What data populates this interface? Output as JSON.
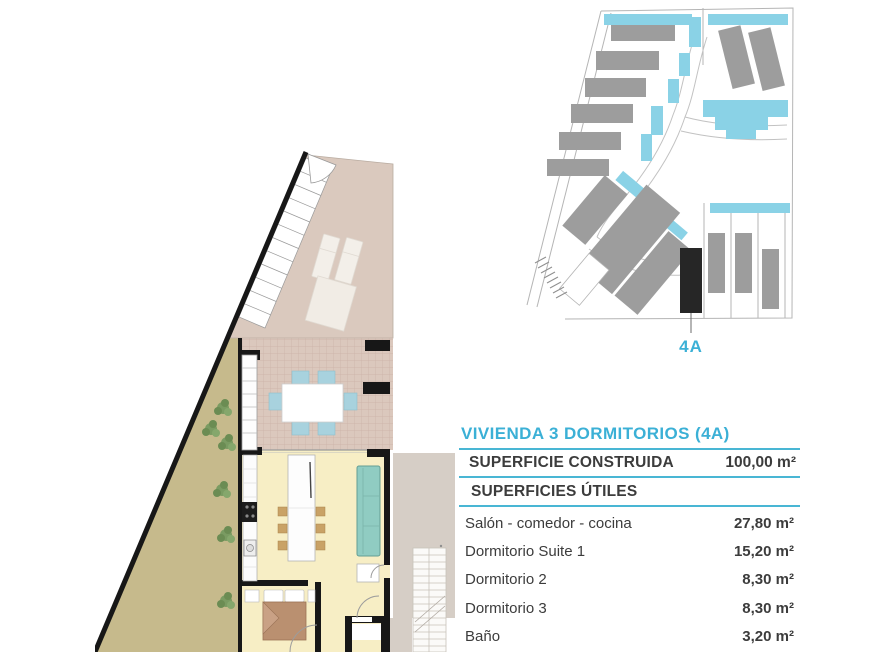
{
  "colors": {
    "accent_cyan": "#3bb0d6",
    "rule_cyan": "#49b6d4",
    "text_dark": "#3c3c3c",
    "building_gray": "#9d9d9d",
    "pool_cyan": "#8ad2e6",
    "highlight_black": "#262626"
  },
  "site_plan": {
    "unit_label": "4A"
  },
  "areas_table": {
    "title": "VIVIENDA 3 DORMITORIOS (4A)",
    "built": {
      "label": "SUPERFICIE CONSTRUIDA",
      "value": "100,00 m²"
    },
    "useful_header": "SUPERFICIES ÚTILES",
    "rows": [
      {
        "label": "Salón - comedor - cocina",
        "value": "27,80 m²"
      },
      {
        "label": "Dormitorio Suite 1",
        "value": "15,20 m²"
      },
      {
        "label": "Dormitorio 2",
        "value": "8,30 m²"
      },
      {
        "label": "Dormitorio 3",
        "value": "8,30 m²"
      },
      {
        "label": "Baño",
        "value": "3,20 m²"
      },
      {
        "label": "Distribuidor",
        "value": "4,30 m²"
      }
    ]
  }
}
